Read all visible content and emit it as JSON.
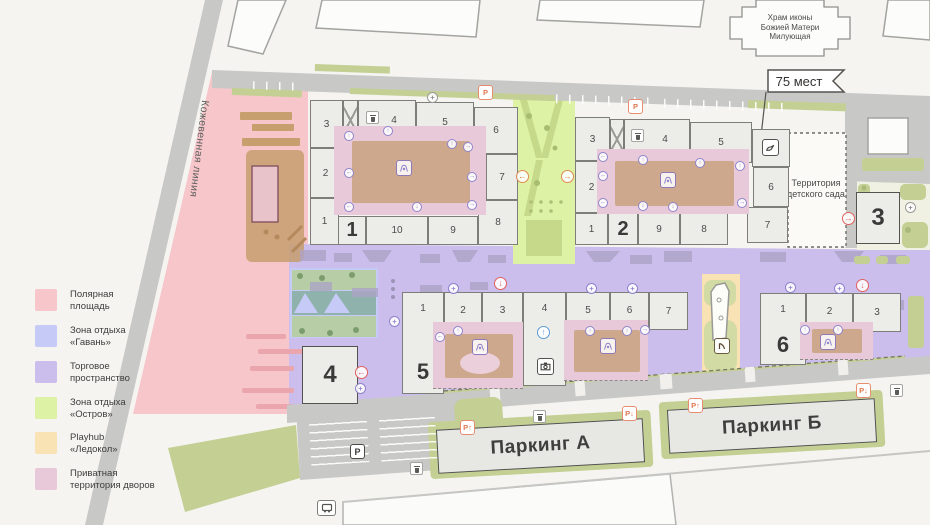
{
  "colors": {
    "polar_square": "#f7c6ca",
    "harbor": "#c5caf6",
    "retail": "#cbbdec",
    "island": "#ddf2a5",
    "playhub": "#f9e2b4",
    "private_yards": "#e7c9da",
    "road": "#c8c8c6",
    "greenery": "#c3cf93",
    "marker_red": "#e0605e",
    "marker_orange": "#e08a4e",
    "marker_purple": "#8f83cc",
    "marker_blue": "#5d9bd3"
  },
  "legend": {
    "items": [
      {
        "l1": "Полярная",
        "l2": "площадь",
        "color": "#f7c6ca"
      },
      {
        "l1": "Зона отдыха",
        "l2": "«Гавань»",
        "color": "#c5caf6"
      },
      {
        "l1": "Торговое",
        "l2": "пространство",
        "color": "#cbbdec"
      },
      {
        "l1": "Зона отдыха",
        "l2": "«Остров»",
        "color": "#ddf2a5"
      },
      {
        "l1": "Playhub",
        "l2": "«Ледокол»",
        "color": "#f9e2b4"
      },
      {
        "l1": "Приватная",
        "l2": "территория дворов",
        "color": "#e7c9da"
      }
    ]
  },
  "map": {
    "street": "Кожевенная линия",
    "church": {
      "l1": "Храм иконы",
      "l2": "Божией Матери",
      "l3": "Милующая"
    },
    "flag": "75 мест",
    "kindergarten": {
      "l1": "Территория",
      "l2": "детского сада"
    },
    "parking_a": "Паркинг А",
    "parking_b": "Паркинг Б"
  },
  "signs": {
    "p": "P",
    "p_up": "P↑",
    "p_down": "P↓"
  },
  "buildings": {
    "b1": {
      "big": "1",
      "left": [
        "3",
        "2",
        "1"
      ],
      "top": [
        "4",
        "5",
        "6"
      ],
      "right": [
        "7",
        "8"
      ],
      "bottom": [
        "10",
        "9"
      ]
    },
    "b2": {
      "big": "2",
      "left": [
        "3",
        "2"
      ],
      "top": [
        "4",
        "5"
      ],
      "right": [
        "6",
        "7"
      ],
      "bottom": [
        "1",
        "9",
        "8"
      ]
    },
    "b3": {
      "big": "3"
    },
    "b4": {
      "big": "4"
    },
    "b5": {
      "big": "5",
      "cells": [
        "1",
        "2",
        "3",
        "4",
        "5",
        "6",
        "7"
      ]
    },
    "b6": {
      "big": "6",
      "cells": [
        "1",
        "2",
        "3"
      ]
    }
  }
}
